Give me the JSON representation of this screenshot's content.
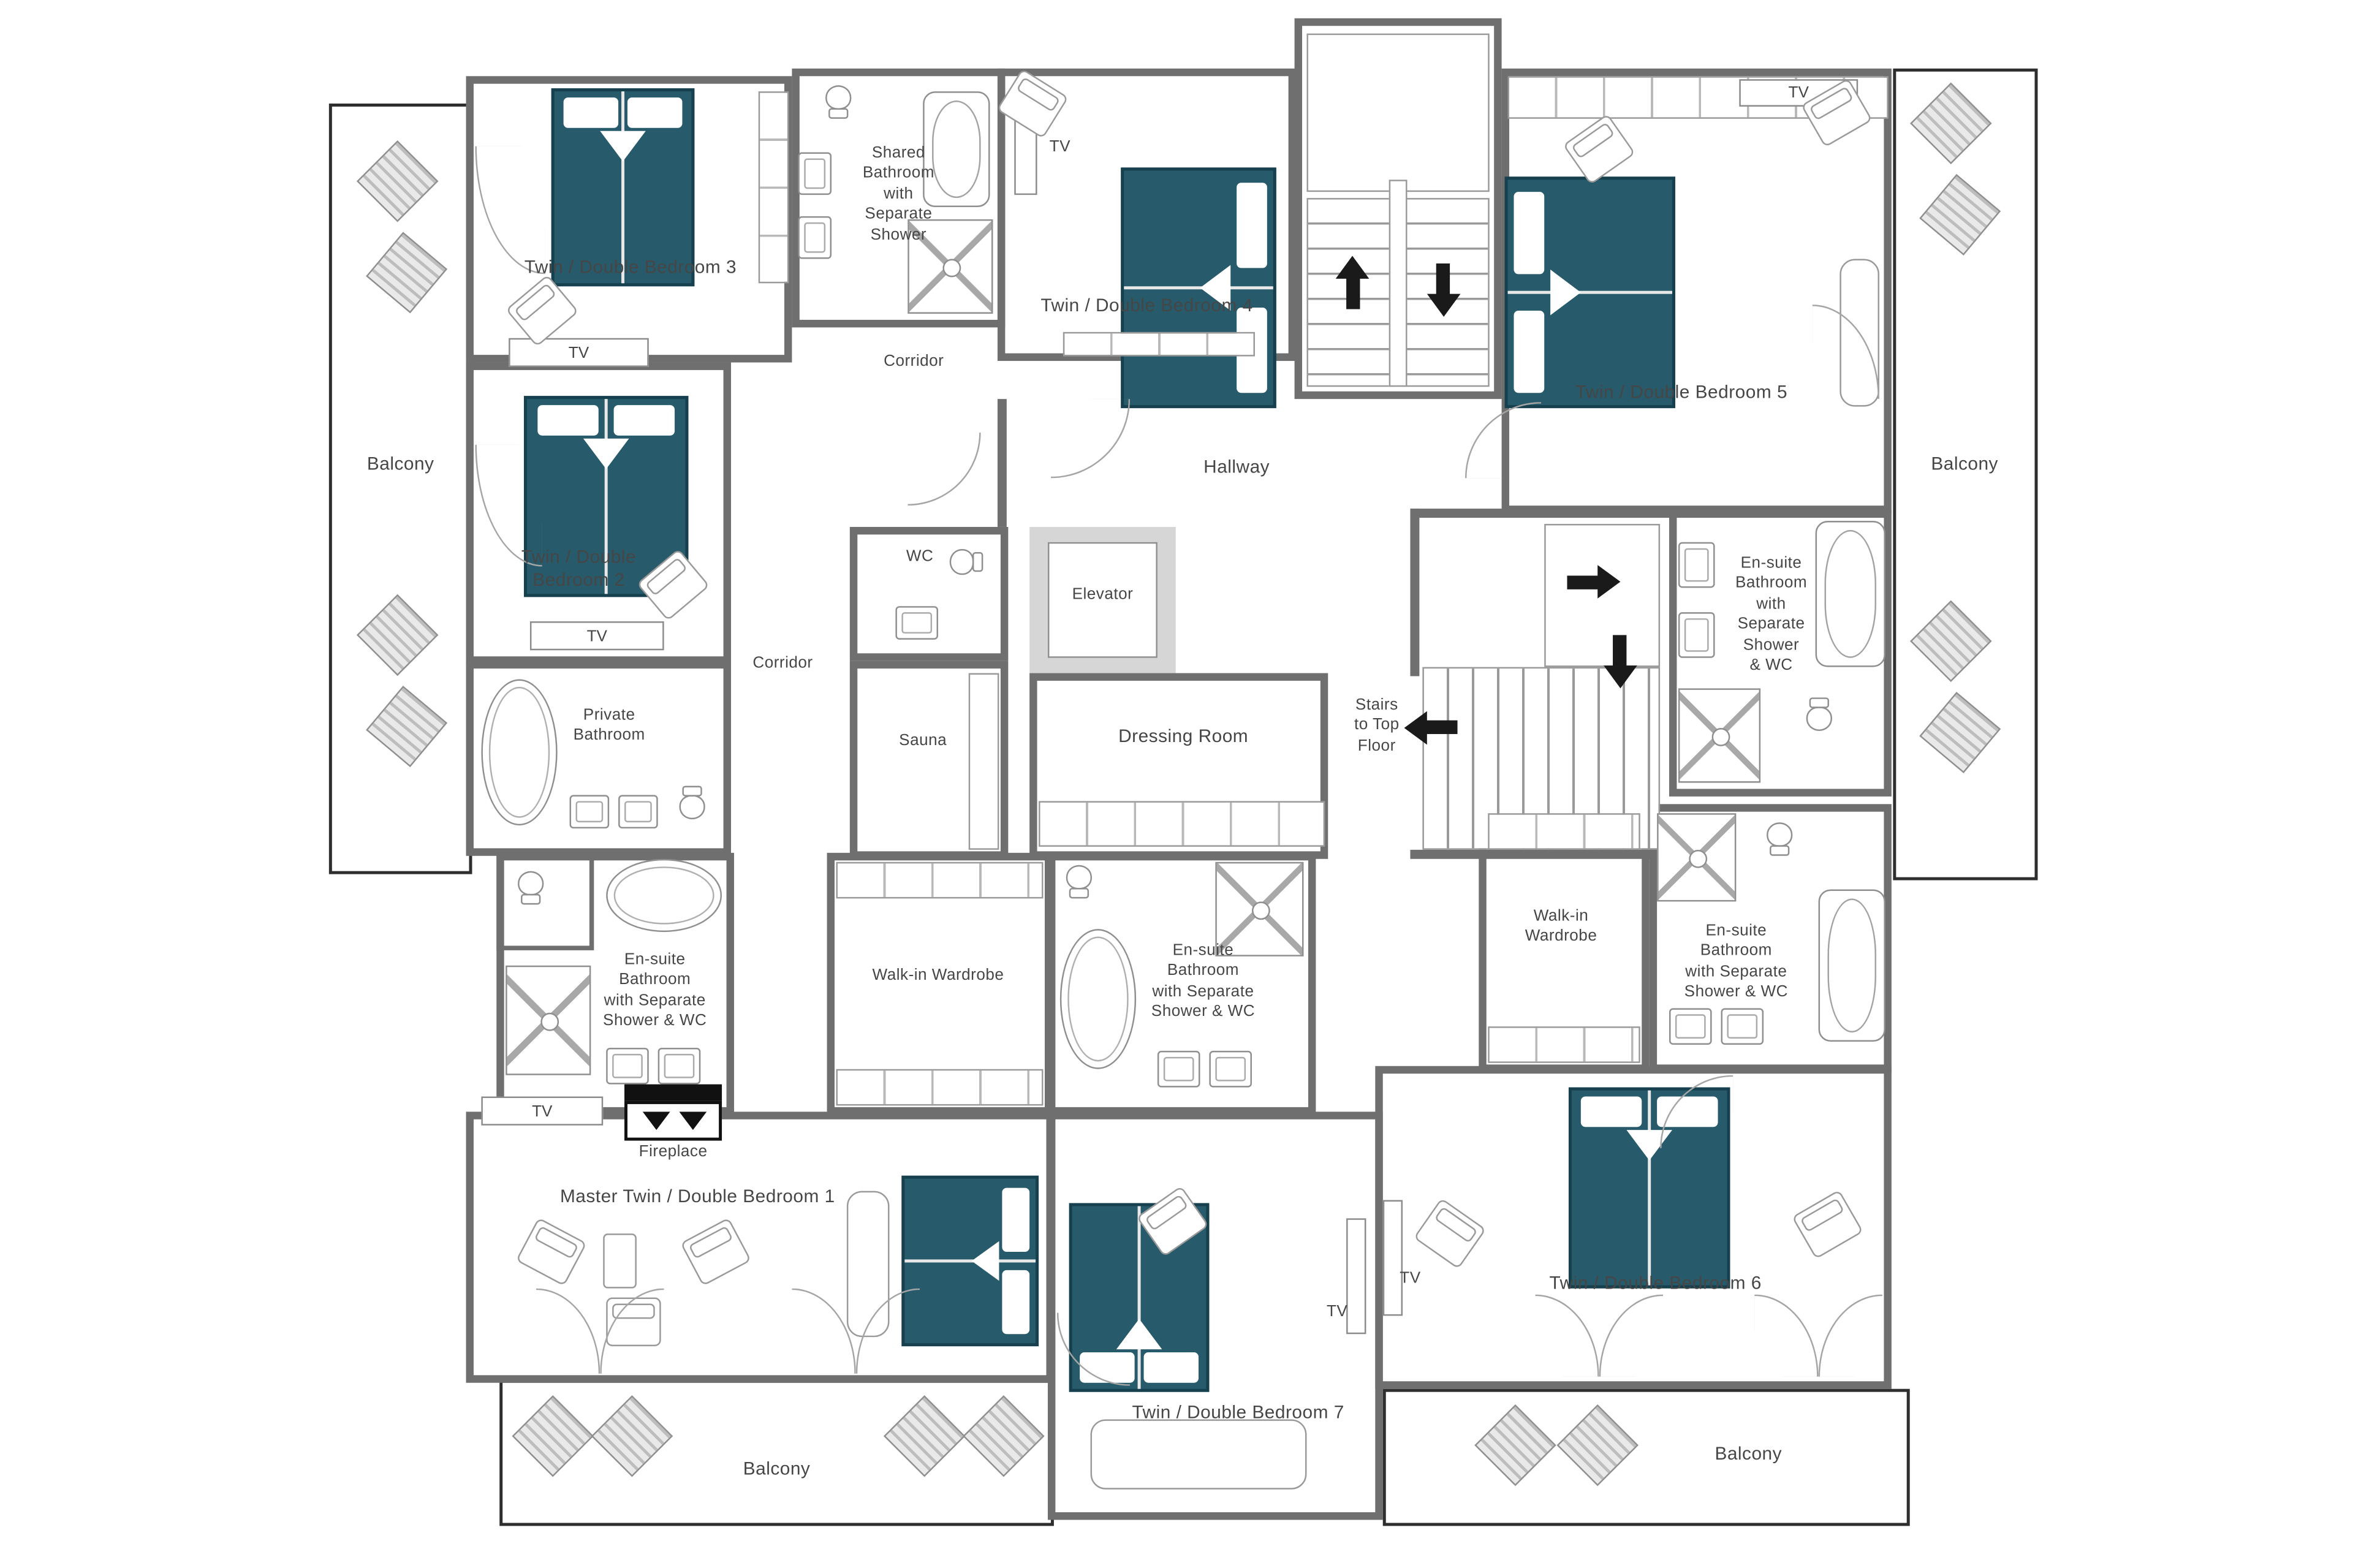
{
  "colors": {
    "bed_teal": "#275a6a",
    "wall_gray": "#6f6f6f",
    "text_gray": "#464646",
    "balcony_outline": "#2e2e2e"
  },
  "rooms": {
    "bedroom3": "Twin / Double Bedroom 3",
    "shared_bathroom": "Shared\nBathroom\nwith\nSeparate\nShower",
    "corridor_top": "Corridor",
    "bedroom4": "Twin / Double Bedroom 4",
    "bedroom5": "Twin / Double Bedroom 5",
    "hallway": "Hallway",
    "bedroom2": "Twin / Double\nBedroom 2",
    "wc": "WC",
    "elevator": "Elevator",
    "corridor_left": "Corridor",
    "sauna": "Sauna",
    "dressing_room": "Dressing Room",
    "stairs": "Stairs\nto Top\nFloor",
    "ensuite_bedroom5": "En-suite\nBathroom\nwith\nSeparate\nShower\n& WC",
    "private_bathroom": "Private\nBathroom",
    "ensuite_master": "En-suite\nBathroom\nwith Separate\nShower & WC",
    "wardrobe_master": "Walk-in Wardrobe",
    "ensuite_bedroom7": "En-suite\nBathroom\nwith Separate\nShower & WC",
    "wardrobe_bedroom6": "Walk-in\nWardrobe",
    "ensuite_bedroom6": "En-suite\nBathroom\nwith Separate\nShower & WC",
    "fireplace": "Fireplace",
    "master_bedroom1": "Master Twin / Double Bedroom 1",
    "bedroom7": "Twin / Double Bedroom 7",
    "bedroom6": "Twin / Double Bedroom 6",
    "balcony_left": "Balcony",
    "balcony_right": "Balcony",
    "balcony_bottom_left": "Balcony",
    "balcony_bottom_right": "Balcony"
  },
  "fixtures": {
    "tv": "TV"
  }
}
